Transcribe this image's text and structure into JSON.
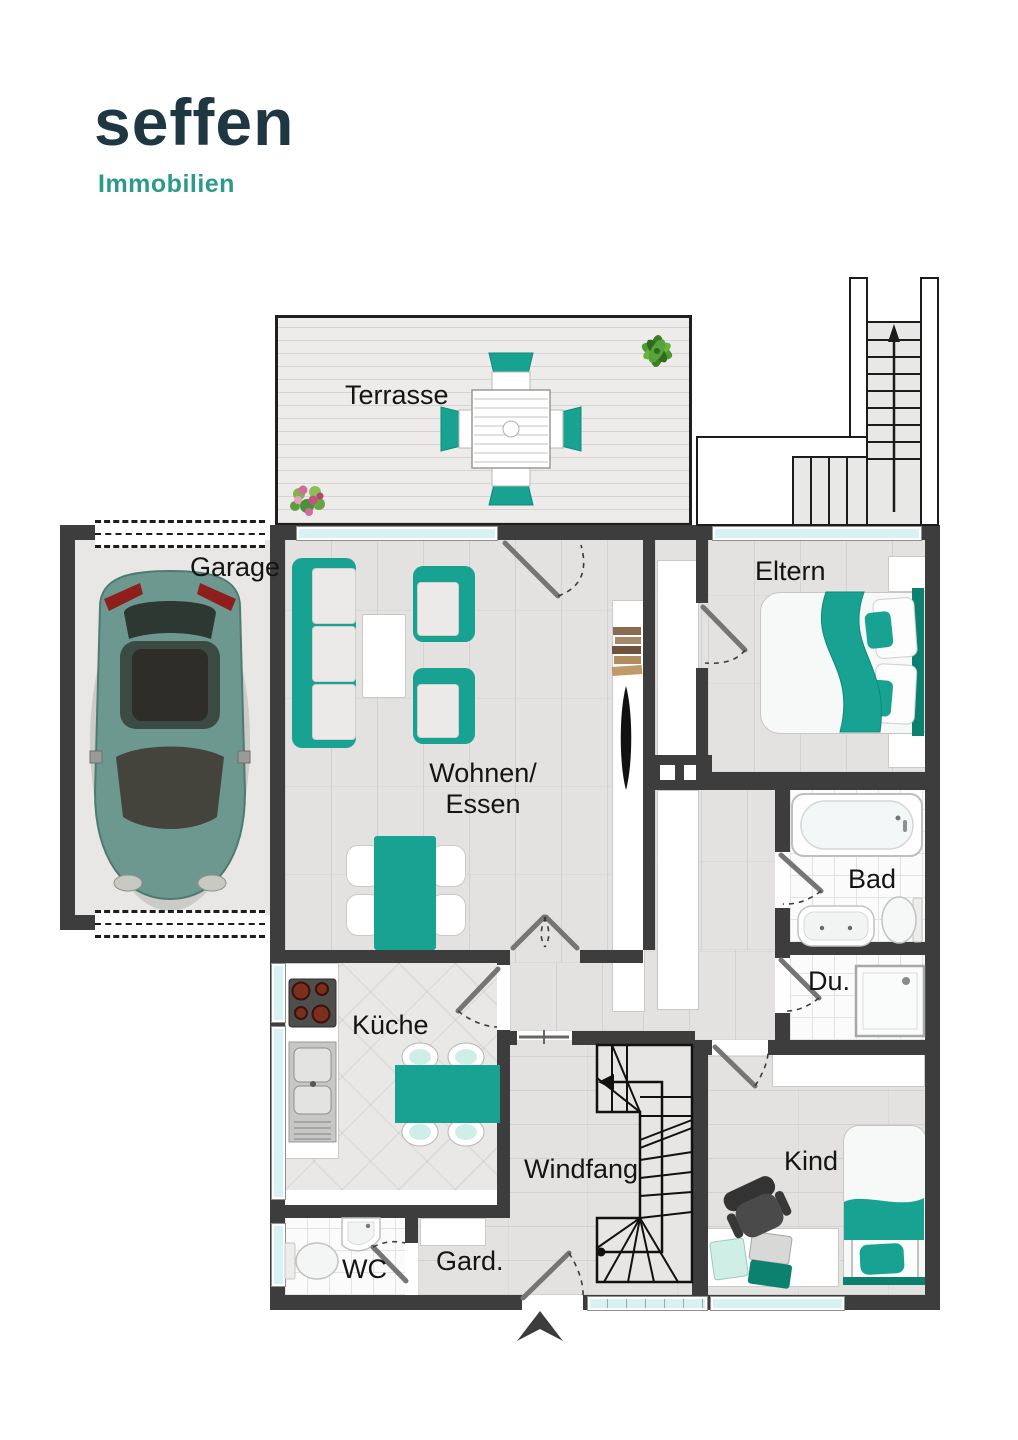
{
  "brand": {
    "name": "seffen",
    "tagline": "Immobilien"
  },
  "theme": {
    "wall": "#3d3d3d",
    "accent": "#18a291",
    "accent_dark": "#0d8170",
    "glass": "#d8f1f3",
    "logo_primary": "#1e3742",
    "logo_accent": "#2c9a8b",
    "label_color": "#141414",
    "car_body": "#6d988f"
  },
  "rooms": {
    "terrasse": {
      "label": "Terrasse"
    },
    "garage": {
      "label": "Garage"
    },
    "wohnen": {
      "line1": "Wohnen/",
      "line2": "Essen"
    },
    "eltern": {
      "label": "Eltern"
    },
    "bad": {
      "label": "Bad"
    },
    "dusche": {
      "label": "Du."
    },
    "kueche": {
      "label": "Küche"
    },
    "windfang": {
      "label": "Windfang"
    },
    "kind": {
      "label": "Kind"
    },
    "wc": {
      "label": "WC"
    },
    "garderobe": {
      "label": "Gard."
    }
  }
}
